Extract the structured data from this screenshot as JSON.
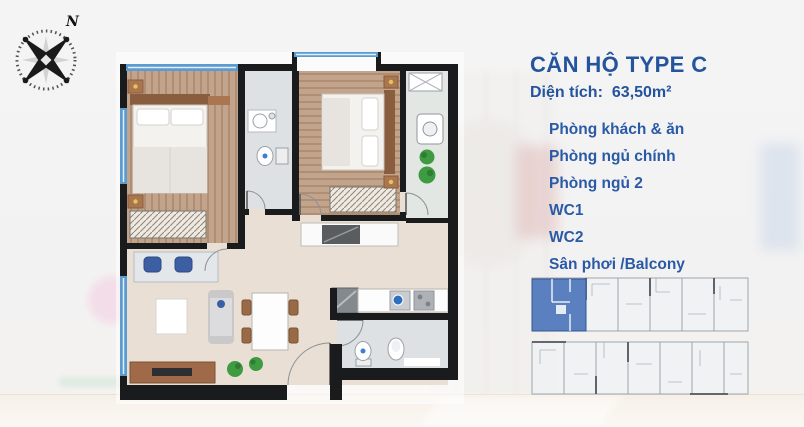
{
  "header": {
    "title": "CĂN HỘ TYPE C",
    "area_label": "Diện tích:",
    "area_value": "63,50m²"
  },
  "rooms": [
    "Phòng khách & ăn",
    "Phòng ngủ chính",
    "Phòng ngủ 2",
    "WC1",
    "WC2",
    "Sân phơi /Balcony"
  ],
  "compass": {
    "north_label": "N"
  },
  "colors": {
    "accent_text_blue": "#24549c",
    "highlighted_unit_blue": "#5b80c0",
    "wall_black": "#1a1b1d",
    "window_blue": "#5b9bd0",
    "wood_floor": "#c2a38b",
    "living_floor": "#e9dfd4",
    "wc_floor": "#dde1e4"
  }
}
